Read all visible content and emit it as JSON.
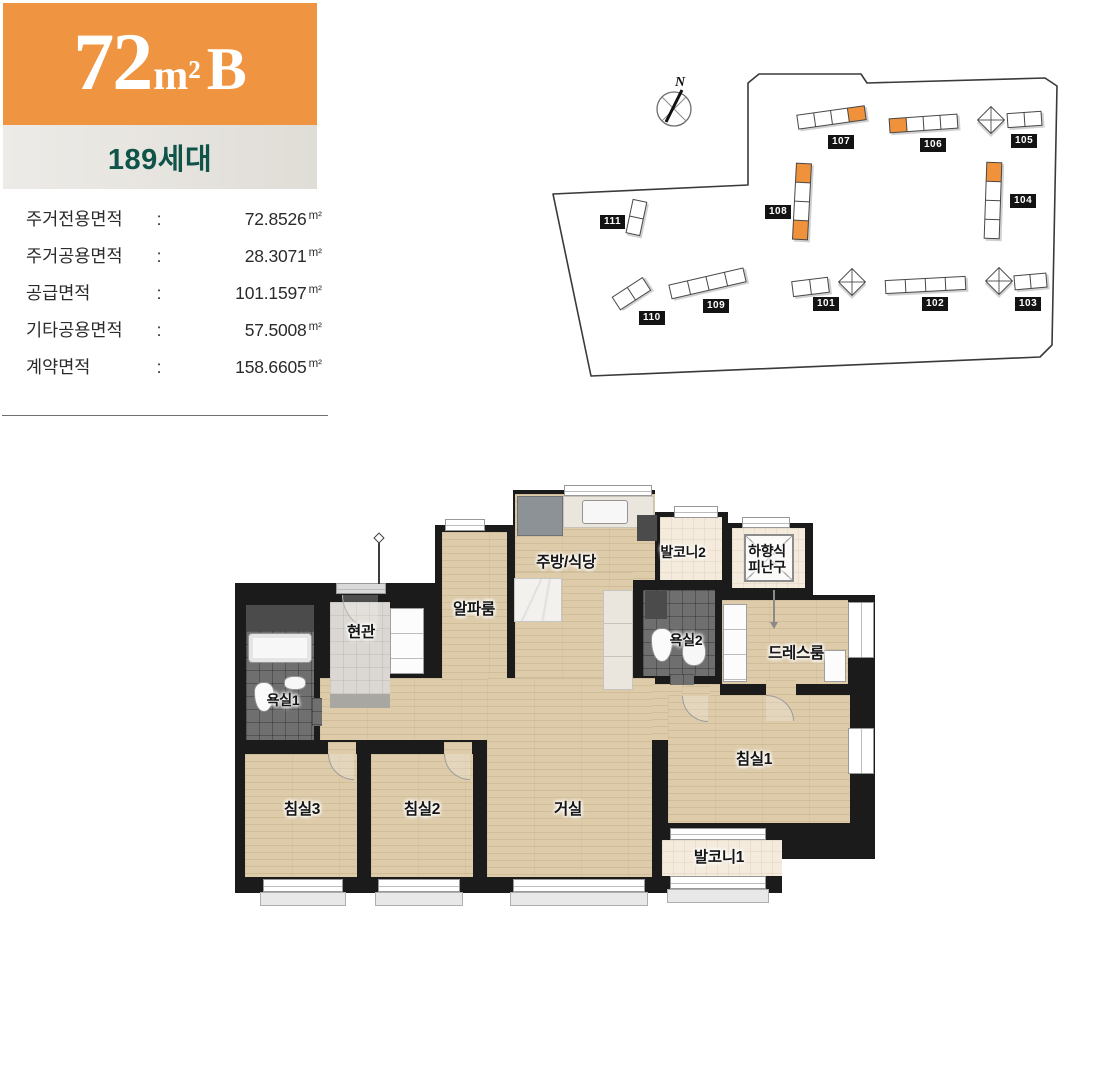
{
  "header": {
    "plan_name": {
      "size": "72",
      "unit": "m²",
      "variant": "B"
    },
    "households": "189세대"
  },
  "area_info": {
    "rows": [
      {
        "label": "주거전용면적",
        "value": "72.8526",
        "unit": "m²"
      },
      {
        "label": "주거공용면적",
        "value": "28.3071",
        "unit": "m²"
      },
      {
        "label": "공급면적",
        "value": "101.1597",
        "unit": "m²"
      },
      {
        "label": "기타공용면적",
        "value": "57.5008",
        "unit": "m²"
      },
      {
        "label": "계약면적",
        "value": "158.6605",
        "unit": "m²"
      }
    ]
  },
  "site_plan": {
    "north_label": "N",
    "buildings": [
      {
        "num": "101"
      },
      {
        "num": "102"
      },
      {
        "num": "103"
      },
      {
        "num": "104"
      },
      {
        "num": "105"
      },
      {
        "num": "106"
      },
      {
        "num": "107"
      },
      {
        "num": "108"
      },
      {
        "num": "109"
      },
      {
        "num": "110"
      },
      {
        "num": "111"
      }
    ]
  },
  "floor_plan": {
    "rooms": {
      "kitchen": "주방/식당",
      "balcony2": "발코니2",
      "hatch_line1": "하향식",
      "hatch_line2": "피난구",
      "alpha": "알파룸",
      "entry": "현관",
      "bath2": "욕실2",
      "dress": "드레스룸",
      "bath1": "욕실1",
      "bed3": "침실3",
      "bed2": "침실2",
      "living": "거실",
      "bed1": "침실1",
      "balcony1": "발코니1"
    }
  },
  "colors": {
    "accent_orange": "#EF9440",
    "teal": "#0F5349",
    "wall": "#1B1B1B",
    "wood": "#DDCBA9"
  }
}
